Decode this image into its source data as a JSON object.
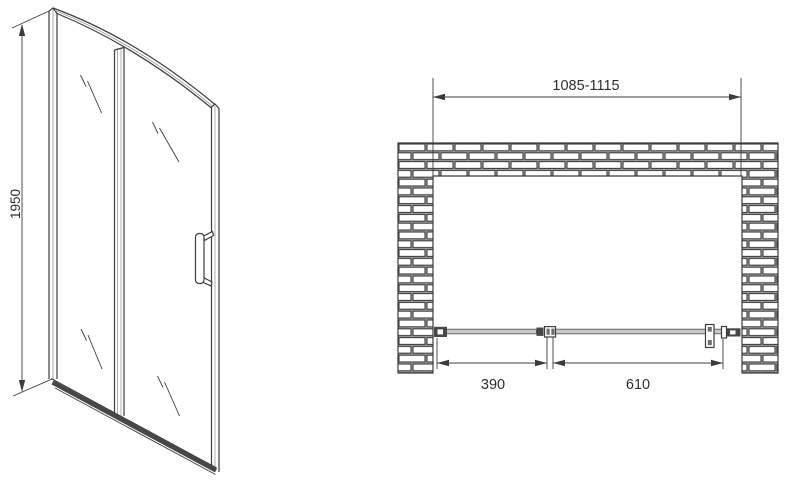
{
  "colors": {
    "bg": "#ffffff",
    "line": "#3c3c3c",
    "line2": "#9a9a9a",
    "dark": "#474747",
    "glass": "#c9c9c9",
    "text": "#2e2e2e"
  },
  "front_view": {
    "height_dimension": {
      "label": "1950"
    }
  },
  "plan_view": {
    "width_dimension": {
      "label": "1085-1115"
    },
    "fixed_panel_dimension": {
      "label": "390"
    },
    "door_panel_dimension": {
      "label": "610"
    }
  }
}
